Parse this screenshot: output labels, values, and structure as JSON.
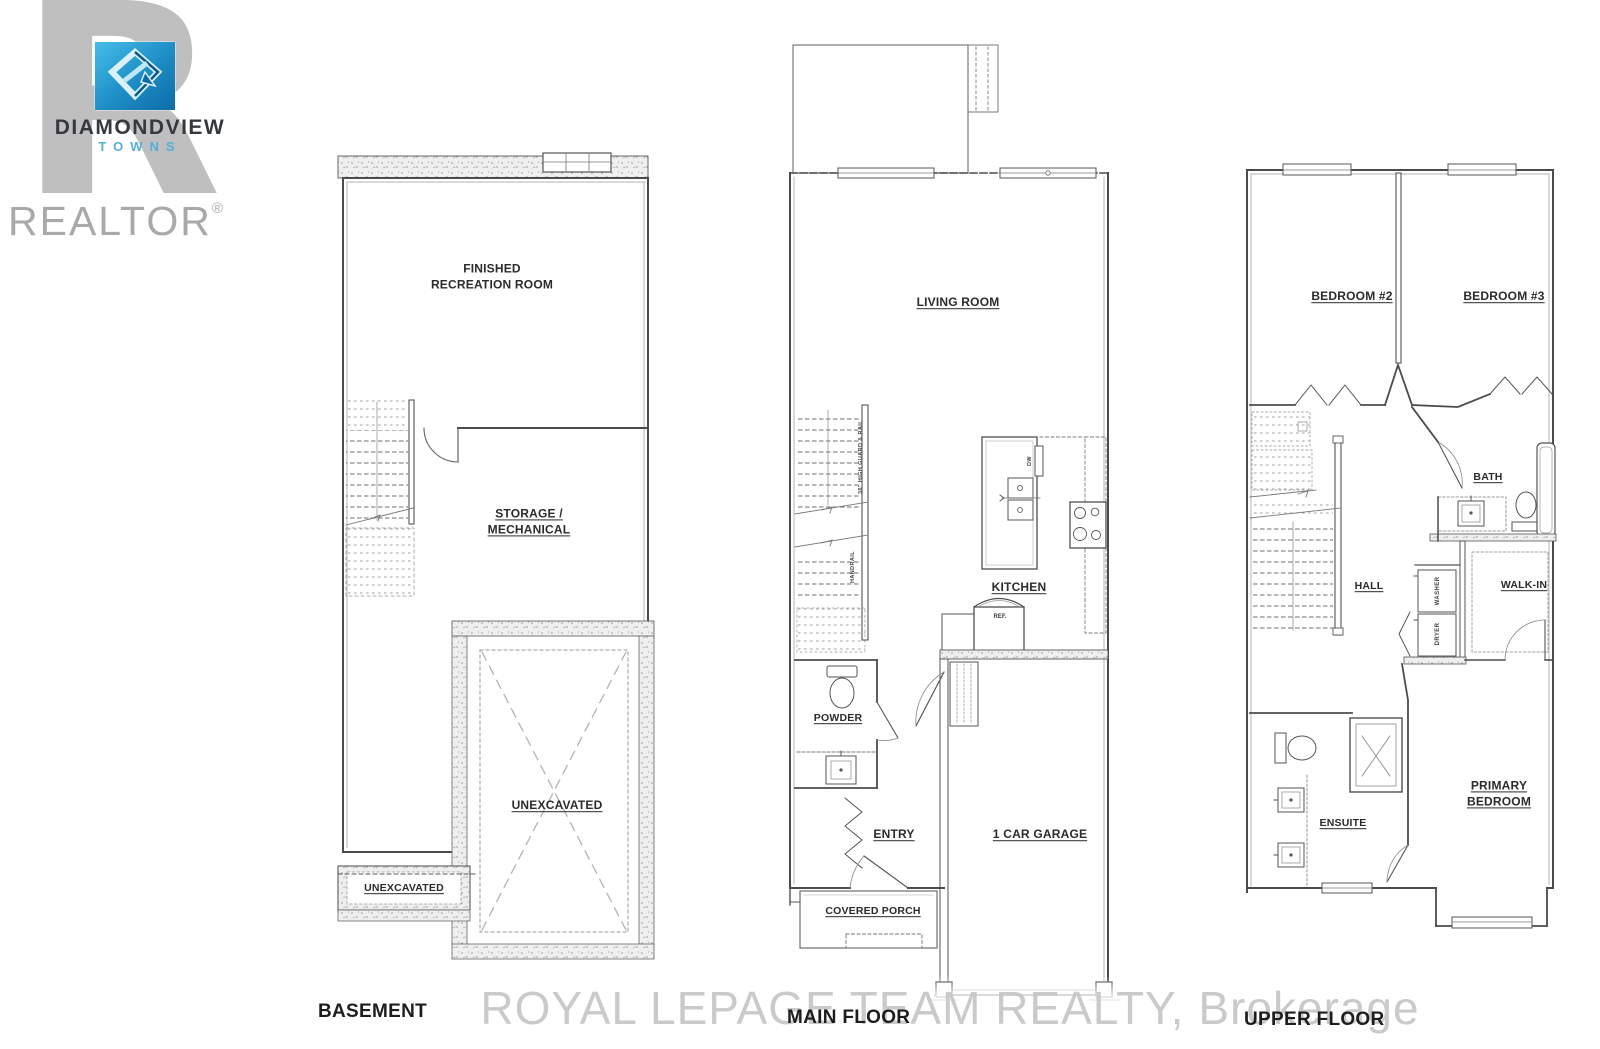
{
  "logo": {
    "brand": "DIAMONDVIEW",
    "sub": "TOWNS",
    "realtor": "REALTOR",
    "registered": "®"
  },
  "watermark": "ROYAL LEPAGE TEAM REALTY, Brokerage",
  "colors": {
    "logo_blue_light": "#45bdeb",
    "logo_blue_dark": "#0d6ca6",
    "towns_blue": "#55aed8",
    "watermark_gray": "#c6c6c6",
    "line_gray": "#4b4b4b"
  },
  "plans": {
    "basement": {
      "title": "BASEMENT",
      "labels": {
        "rec_room": "FINISHED\nRECREATION ROOM",
        "storage": "STORAGE /\nMECHANICAL",
        "unexcavated_main": "UNEXCAVATED",
        "unexcavated_strip": "UNEXCAVATED"
      }
    },
    "main": {
      "title": "MAIN FLOOR",
      "labels": {
        "living": "LIVING ROOM",
        "kitchen": "KITCHEN",
        "powder": "POWDER",
        "entry": "ENTRY",
        "garage": "1 CAR GARAGE",
        "porch": "COVERED PORCH",
        "guard": "36\" HIGH GUARD & RAIL",
        "handrail": "HANDRAIL",
        "dw": "DW",
        "ref": "REF."
      }
    },
    "upper": {
      "title": "UPPER FLOOR",
      "labels": {
        "bedroom2": "BEDROOM #2",
        "bedroom3": "BEDROOM #3",
        "bath": "BATH",
        "hall": "HALL",
        "walkin": "WALK-IN",
        "primary": "PRIMARY\nBEDROOM",
        "ensuite": "ENSUITE",
        "washer": "WASHER",
        "dryer": "DRYER"
      }
    }
  }
}
